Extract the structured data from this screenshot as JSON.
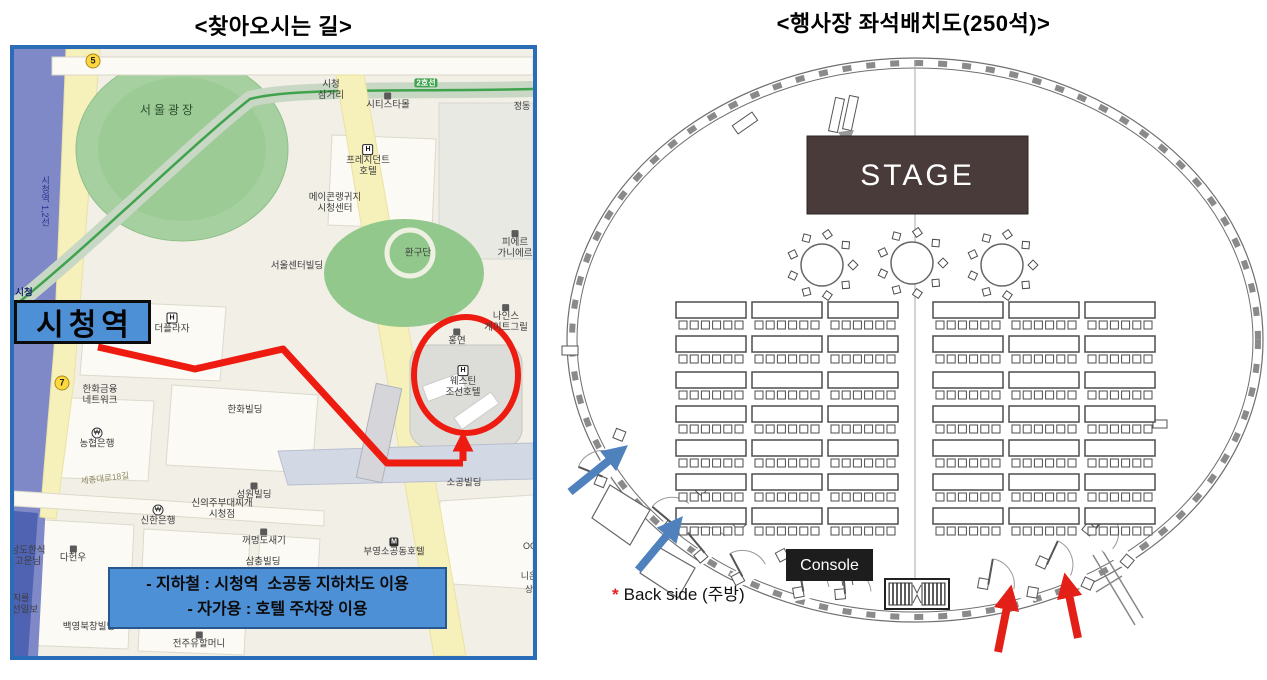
{
  "left_panel": {
    "title": "<찾아오시는 길>",
    "station_box": "시청역",
    "info_box": {
      "line1": "- 지하철 : 시청역  소공동 지하차도 이용",
      "line2": "- 자가용 : 호텔 주차장 이용"
    },
    "map_labels": [
      {
        "t": "서울광장",
        "x": 154,
        "y": 62,
        "s": 12,
        "ls": 3,
        "c": "#2f4f2f"
      },
      {
        "t": "시청\n삼거리",
        "x": 317,
        "y": 42,
        "s": 9.5
      },
      {
        "t": "시티스타몰",
        "x": 374,
        "y": 53,
        "s": 9.5,
        "icon": "B"
      },
      {
        "t": "2호선",
        "x": 412,
        "y": 34,
        "s": 8,
        "cls": "badge"
      },
      {
        "t": "정동",
        "x": 508,
        "y": 57,
        "s": 9
      },
      {
        "t": "프레지던트\n호텔",
        "x": 354,
        "y": 112,
        "s": 9.5,
        "icon": "H"
      },
      {
        "t": "메이콘랭귀지\n시청센터",
        "x": 321,
        "y": 155,
        "s": 9.5
      },
      {
        "t": "피에르\n가니에르",
        "x": 501,
        "y": 196,
        "s": 9.5,
        "icon": "B"
      },
      {
        "t": "환구단",
        "x": 404,
        "y": 205,
        "s": 9.5
      },
      {
        "t": "서울센터빌딩",
        "x": 283,
        "y": 218,
        "s": 9.5
      },
      {
        "t": "나인스\n게이트그릴",
        "x": 492,
        "y": 270,
        "s": 9.5,
        "icon": "B"
      },
      {
        "t": "홍연",
        "x": 443,
        "y": 289,
        "s": 9.5,
        "icon": "B"
      },
      {
        "t": "웨스틴\n조선호텔",
        "x": 449,
        "y": 333,
        "s": 9.5,
        "icon": "H"
      },
      {
        "t": "더플라자",
        "x": 158,
        "y": 275,
        "s": 9.5,
        "icon": "H"
      },
      {
        "t": "한화금융\n네트워크",
        "x": 86,
        "y": 347,
        "s": 9.5
      },
      {
        "t": "농협은행",
        "x": 83,
        "y": 390,
        "s": 9.5,
        "icon": "W"
      },
      {
        "t": "한화빌딩",
        "x": 231,
        "y": 362,
        "s": 9.5
      },
      {
        "t": "세종대로18길",
        "x": 91,
        "y": 430,
        "s": 8.5,
        "rot": -7,
        "c": "#8e8866"
      },
      {
        "t": "신한은행",
        "x": 144,
        "y": 467,
        "s": 9.5,
        "icon": "W"
      },
      {
        "t": "신의주부대찌개\n시청점",
        "x": 208,
        "y": 461,
        "s": 9.5
      },
      {
        "t": "성원빌딩",
        "x": 240,
        "y": 443,
        "s": 9.5,
        "icon": "B"
      },
      {
        "t": "꺼멍도새기",
        "x": 250,
        "y": 489,
        "s": 9.5,
        "icon": "B"
      },
      {
        "t": "삼충빌딩",
        "x": 249,
        "y": 514,
        "s": 9.5
      },
      {
        "t": "다헌우",
        "x": 59,
        "y": 506,
        "s": 9.5,
        "icon": "B"
      },
      {
        "t": "남도한식\n고운님",
        "x": 14,
        "y": 508,
        "s": 9.5
      },
      {
        "t": "지를",
        "x": 7,
        "y": 549,
        "s": 9
      },
      {
        "t": "선일보",
        "x": 11,
        "y": 562,
        "s": 9.5
      },
      {
        "t": "백영북창빌딩",
        "x": 75,
        "y": 579,
        "s": 9.5
      },
      {
        "t": "전주유할머니",
        "x": 185,
        "y": 592,
        "s": 9.5,
        "icon": "B"
      },
      {
        "t": "부영소공동호텔",
        "x": 380,
        "y": 499,
        "s": 9.5,
        "icon": "M"
      },
      {
        "t": "소공빌딩",
        "x": 450,
        "y": 435,
        "s": 9.5
      },
      {
        "t": "OO",
        "x": 516,
        "y": 497,
        "s": 9
      },
      {
        "t": "니은",
        "x": 515,
        "y": 527,
        "s": 9
      },
      {
        "t": "상가",
        "x": 519,
        "y": 541,
        "s": 8.5
      },
      {
        "t": "시청",
        "x": 10,
        "y": 245,
        "s": 9.5,
        "c": "#16246e",
        "b": 1
      },
      {
        "t": "시청역 1,2선",
        "x": 31,
        "y": 152,
        "s": 9,
        "vert": 1,
        "c": "#28348a"
      },
      {
        "t": "5",
        "x": 79,
        "y": 12,
        "cls": "num"
      },
      {
        "t": "7",
        "x": 48,
        "y": 334,
        "cls": "num"
      }
    ],
    "route": {
      "points": "84,298 181,320 269,300 373,414 449,414",
      "arrow": {
        "x": 449,
        "y1": 412,
        "y2": 388
      },
      "circle": {
        "cx": 452,
        "cy": 326,
        "rx": 52,
        "ry": 58
      }
    }
  },
  "right_panel": {
    "title": "<행사장 좌석배치도(250석)>",
    "stage_label": "STAGE",
    "console_label": "Console",
    "back_side": {
      "asterisk": "*",
      "text": "Back side (주방)"
    },
    "floorplan": {
      "oval": {
        "cx": 355,
        "cy": 300,
        "rx": 348,
        "ry": 282,
        "inner": 10,
        "tick_dash": "9 15",
        "tick_w": 6
      },
      "center_line": {
        "x": 355,
        "y1": 20,
        "y2": 545
      },
      "stage": {
        "x": 247,
        "y": 96,
        "w": 221,
        "h": 78
      },
      "round_tables": {
        "centers": [
          [
            262,
            225
          ],
          [
            352,
            223
          ],
          [
            442,
            225
          ]
        ],
        "r": 21,
        "chairs": 9,
        "chair_r": 31,
        "chair_size": 7
      },
      "seat_blocks": {
        "col_x": [
          116,
          192,
          268,
          373,
          449,
          525
        ],
        "row_y": [
          262,
          296,
          332,
          366,
          400,
          434,
          468
        ],
        "table_w": 70,
        "table_h": 16,
        "chairs_per_table": 6,
        "chair_size": 8,
        "chair_dy": 19
      },
      "console": {
        "x": 226,
        "y": 509,
        "w": 87,
        "h": 32
      },
      "hatch_desk": {
        "x": 325,
        "y": 539,
        "w": 64,
        "h": 30
      },
      "doors": [
        [
          50,
          418,
          -68
        ],
        [
          125,
          468,
          -50
        ],
        [
          160,
          500,
          -40
        ],
        [
          200,
          527,
          -28
        ],
        [
          263,
          548,
          -10
        ],
        [
          305,
          552,
          -5
        ],
        [
          448,
          548,
          10
        ],
        [
          505,
          533,
          25
        ],
        [
          548,
          505,
          40
        ]
      ],
      "rooms": [
        "50,445 90,470 70,505 32,478",
        "95,505 135,528 118,558 80,533"
      ],
      "stubs": [
        [
          173,
          78,
          24,
          10,
          -35
        ],
        [
          2,
          306,
          16,
          9,
          0
        ],
        [
          272,
          58,
          9,
          34,
          12
        ],
        [
          286,
          56,
          9,
          34,
          12
        ],
        [
          593,
          380,
          14,
          8,
          0
        ]
      ],
      "deco_triangle": "278,92 294,90 287,106",
      "lines": [
        [
          533,
          515,
          575,
          585
        ],
        [
          541,
          508,
          583,
          578
        ],
        [
          536,
          552,
          562,
          536
        ]
      ],
      "blue_arrows": [
        [
          10,
          452,
          62,
          410
        ],
        [
          78,
          530,
          118,
          482
        ]
      ],
      "red_arrows": [
        [
          438,
          612,
          450,
          552
        ],
        [
          518,
          598,
          506,
          540
        ]
      ]
    }
  },
  "colors": {
    "panel_border": "#2b6cb8",
    "label_box_blue": "#4e90d5",
    "route_red": "#ed1b10",
    "stage_bg": "#4a3b3b",
    "console_bg": "#1d1d1d",
    "arrow_blue": "#4f81bd",
    "arrow_red": "#e32017",
    "wall_gray": "#6f6f6f",
    "seat_stroke": "#4d4d4d"
  }
}
